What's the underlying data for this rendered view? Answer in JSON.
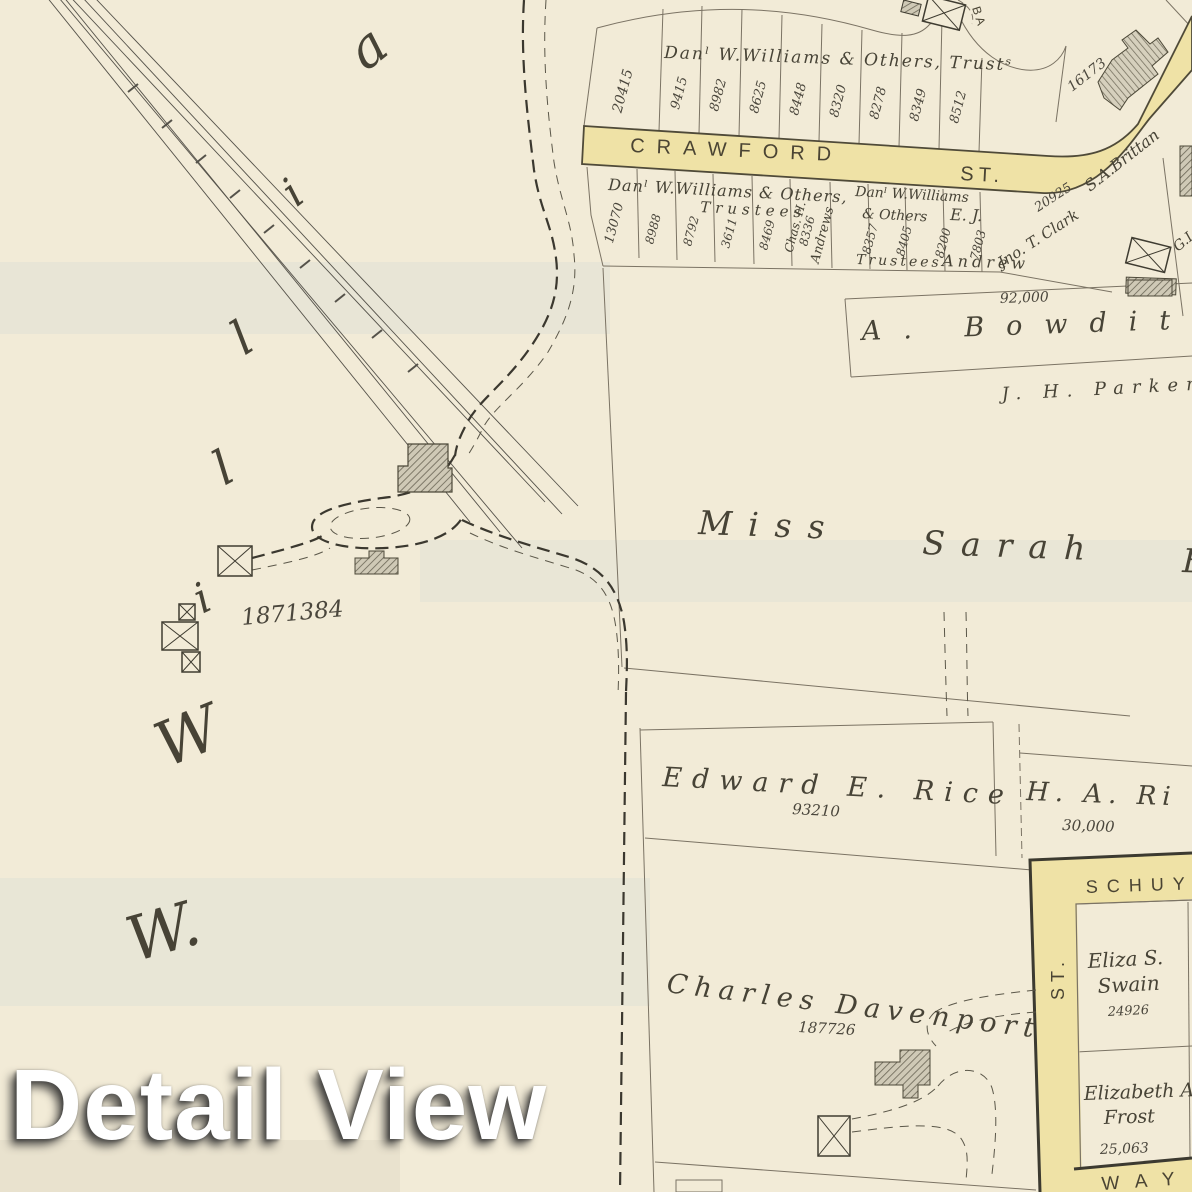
{
  "watermark": {
    "text": "Detail View"
  },
  "streets": {
    "crawford": {
      "name": "CRAWFORD",
      "suffix": "ST."
    },
    "schuyler": {
      "name": "SCHUYLE",
      "vertical": "ST."
    },
    "way": {
      "name": "WAY"
    }
  },
  "top_row": {
    "owner": "Danˡ W.Williams & Others, Trustˢ",
    "lots": [
      "20415",
      "9415",
      "8982",
      "8625",
      "8448",
      "8320",
      "8278",
      "8349",
      "8512"
    ],
    "corner_lot": "16173",
    "corner_owner": "S.A.Brittan",
    "barn_label": "BA"
  },
  "second_row": {
    "owner_line1": "Danˡ W.Williams & Others,",
    "owner_line2": "Trustees",
    "lots": [
      "13070",
      "8988",
      "8792",
      "3611",
      "8469"
    ],
    "andrews": {
      "name_line1": "Chas. H.",
      "lot": "8336",
      "name_line2": "Andrews"
    },
    "williams2": {
      "line1": "Danˡ W.Williams",
      "line2": "& Others",
      "line3": "Trustees",
      "lots": [
        "8357",
        "8405"
      ]
    },
    "ej_andrew": {
      "line1": "E. J.",
      "line2": "Andrew",
      "lots": [
        "8200",
        "7803"
      ]
    },
    "clark": {
      "name": "Jno. T. Clark",
      "lot": "20925"
    },
    "edge_name": "G.I"
  },
  "parcels": {
    "bowditch": {
      "name": "A. Bowditc",
      "area": "92,000"
    },
    "parker": {
      "name": "J. H. Parker"
    },
    "sarah": {
      "part1": "Miss",
      "part2": "Sarah",
      "part3": "B"
    },
    "williams_west": {
      "area": "1871384",
      "letters": [
        "a",
        "i",
        "l",
        "l",
        "i",
        "W",
        "W."
      ]
    },
    "rice": {
      "name": "Edward E. Rice",
      "area": "93210"
    },
    "ha_ri": {
      "name": "H. A. Ri",
      "area": "30,000"
    },
    "swain": {
      "name_line1": "Eliza S.",
      "name_line2": "Swain",
      "area": "24926"
    },
    "frost": {
      "name_line1": "Elizabeth A.",
      "name_line2": "Frost",
      "area": "25,063"
    },
    "davenport": {
      "name": "Charles Davenport",
      "area": "187726"
    }
  }
}
